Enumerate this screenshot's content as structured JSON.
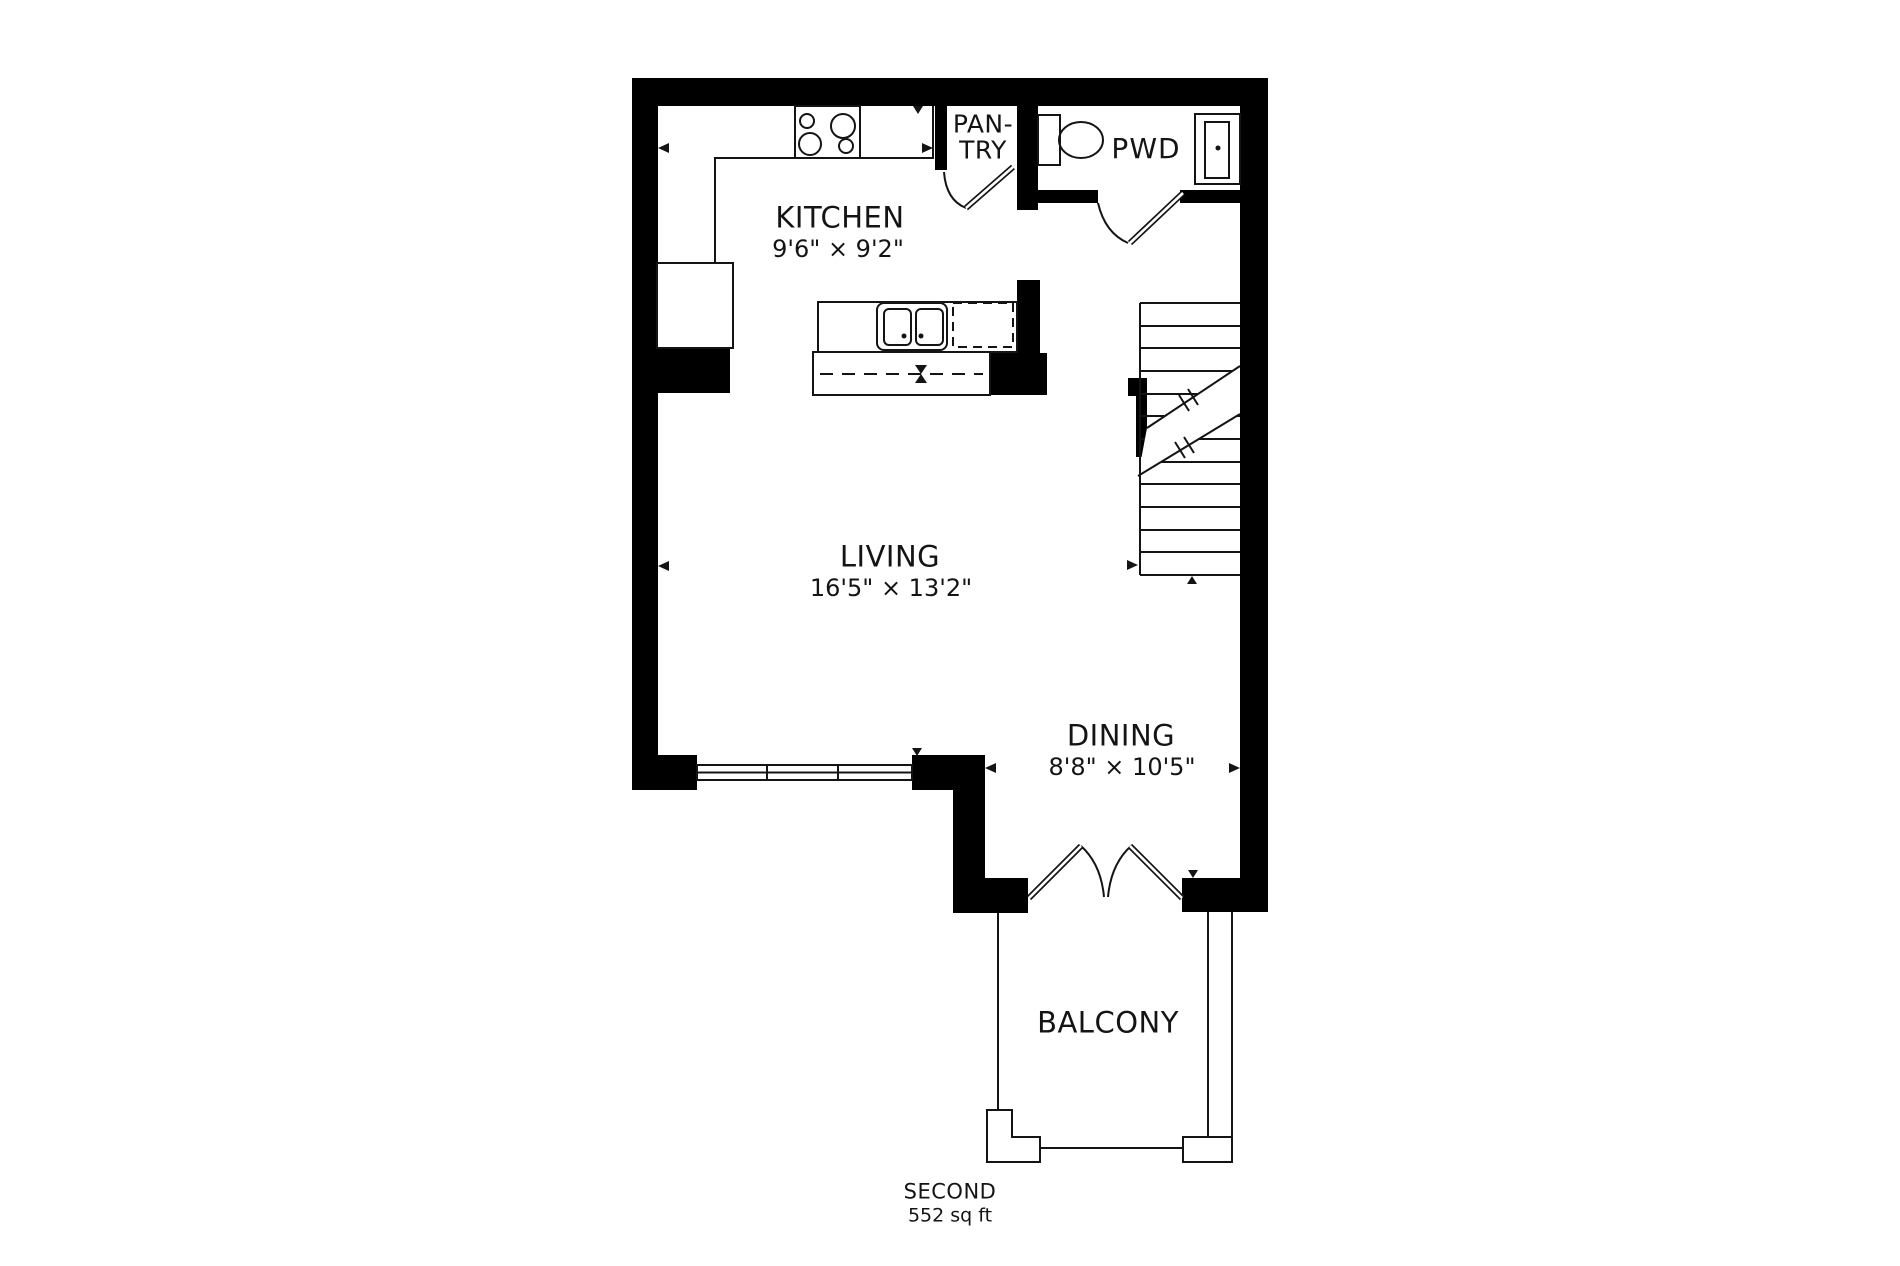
{
  "floorplan": {
    "rooms": {
      "kitchen": {
        "label": "KITCHEN",
        "dimensions": "9'6\" × 9'2\""
      },
      "pantry": {
        "label_line1": "PAN-",
        "label_line2": "TRY"
      },
      "powder_room": {
        "label": "PWD"
      },
      "living": {
        "label": "LIVING",
        "dimensions": "16'5\" × 13'2\""
      },
      "dining": {
        "label": "DINING",
        "dimensions": "8'8\" × 10'5\""
      },
      "balcony": {
        "label": "BALCONY"
      }
    },
    "footer": {
      "floor_name": "SECOND",
      "area": "552 sq ft"
    },
    "colors": {
      "wall": "#000000",
      "line": "#141414",
      "background": "#ffffff"
    }
  }
}
